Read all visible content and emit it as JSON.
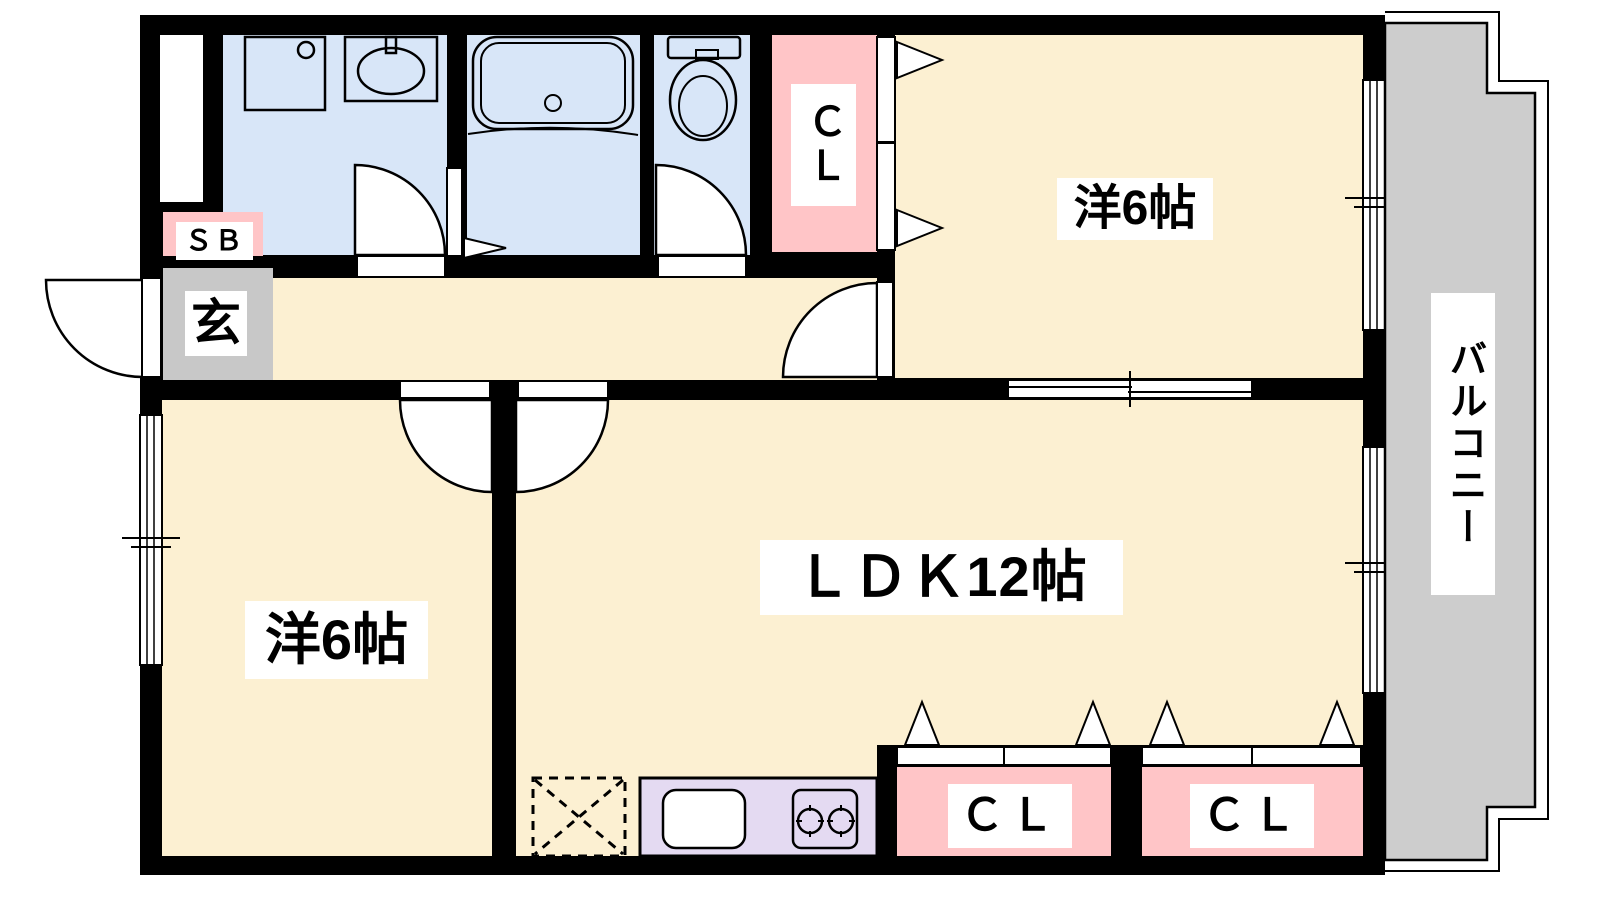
{
  "floorplan": {
    "kind": "apartment-floor-plan",
    "layout_type": "2LDK",
    "rooms": {
      "bedroom_top_right": {
        "label": "洋6帖"
      },
      "bedroom_bottom_left": {
        "label": "洋6帖"
      },
      "ldk": {
        "label": "ＬＤＫ12帖"
      },
      "closet_top": {
        "label": "ＣＬ"
      },
      "closet_bottom_left": {
        "label": "ＣＬ"
      },
      "closet_bottom_right": {
        "label": "ＣＬ"
      },
      "shoe_box": {
        "label": "ＳＢ"
      },
      "entrance": {
        "label": "玄"
      },
      "balcony": {
        "label": "バルコニー"
      }
    },
    "colors": {
      "wall": "#000000",
      "floor_beige": "#FCF0D2",
      "wet_area_blue": "#D8E6F8",
      "closet_pink": "#FFC5C7",
      "kitchen_lavender": "#E4DAF2",
      "entrance_gray": "#C8C8C8",
      "balcony_gray": "#CDCDCD",
      "label_background": "#FFFFFF"
    }
  }
}
